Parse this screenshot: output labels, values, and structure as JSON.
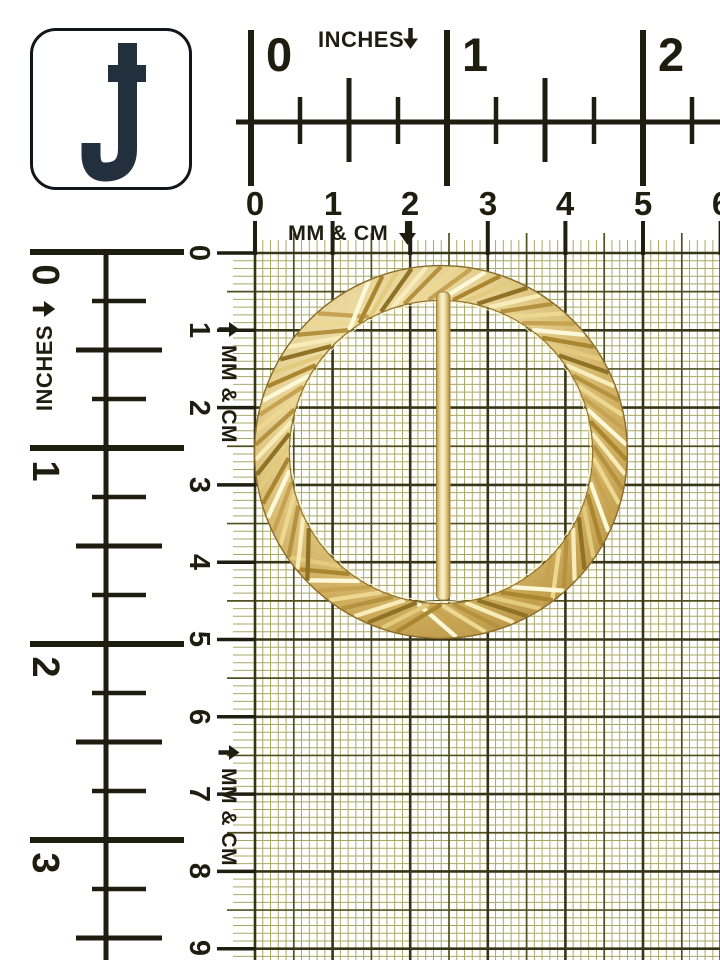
{
  "logo": {
    "monogram": "J"
  },
  "rulers": {
    "inches_top": {
      "unit_label": "INCHES",
      "arrow_icon": "down-arrow",
      "numbers": [
        "0",
        "1",
        "2"
      ]
    },
    "cm_top": {
      "unit_label": "MM & CM",
      "arrow_icon": "down-arrow",
      "numbers": [
        "0",
        "1",
        "2",
        "3",
        "4",
        "5",
        "6"
      ]
    },
    "inches_left": {
      "unit_label": "INCHES",
      "arrow_icon": "right-arrow",
      "numbers": [
        "0",
        "1",
        "2",
        "3"
      ]
    },
    "cm_left": {
      "unit_label": "MM & CM",
      "arrow_icon": "right-arrow",
      "numbers": [
        "0",
        "1",
        "2",
        "3",
        "4",
        "5",
        "6",
        "7",
        "8",
        "9"
      ]
    }
  },
  "subject": {
    "description": "Gold-tone ribbed circular buckle with vertical center bar photographed on a millimeter grid"
  },
  "colors": {
    "ruler_ink": "#1e1e10",
    "grid_fine": "#a9a966",
    "grid_medium": "#50501f",
    "grid_heavy": "#363616",
    "gold_light": "#f8edbe",
    "gold_mid": "#e4cf8e",
    "gold_deep": "#b08c3c",
    "logo_ink": "#22303d"
  }
}
